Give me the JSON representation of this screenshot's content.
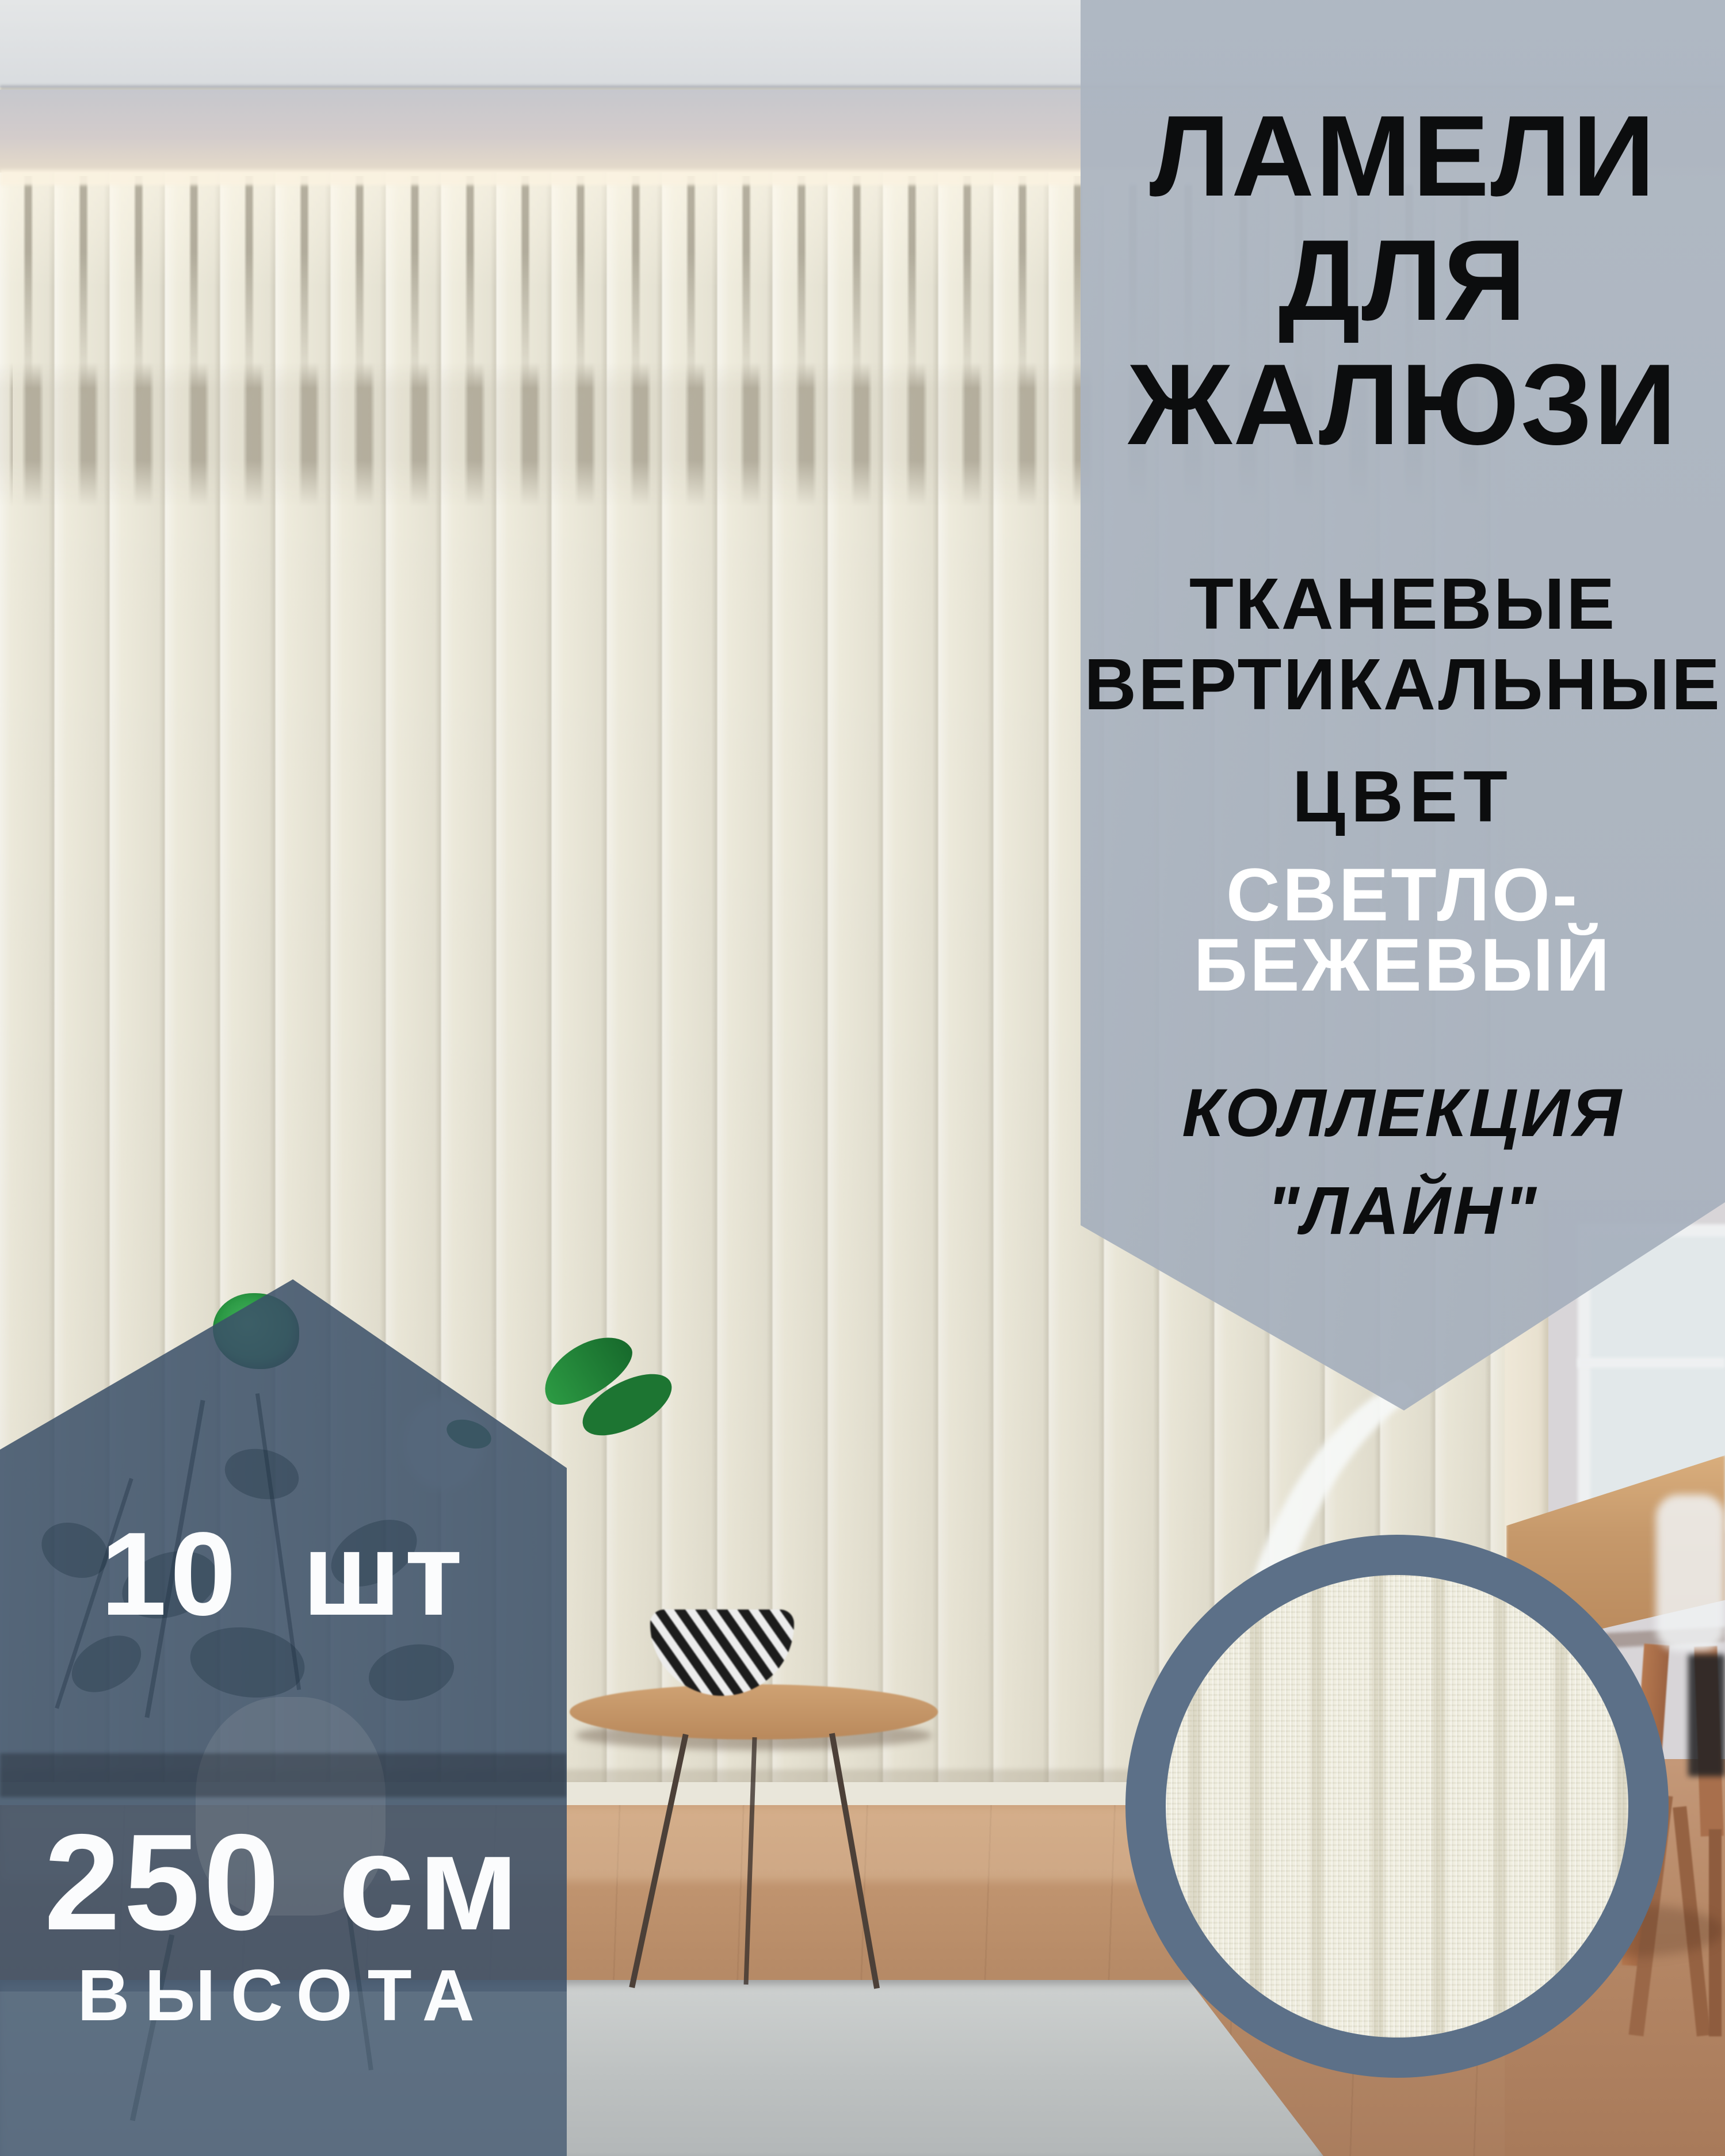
{
  "info_banner": {
    "title": [
      "ЛАМЕЛИ",
      "ДЛЯ",
      "ЖАЛЮЗИ"
    ],
    "material": [
      "ТКАНЕВЫЕ",
      "ВЕРТИКАЛЬНЫЕ"
    ],
    "color_label": "ЦВЕТ",
    "color_value": [
      "СВЕТЛО-",
      "БЕЖЕВЫЙ"
    ],
    "collection": [
      "КОЛЛЕКЦИЯ",
      "\"ЛАЙН\""
    ]
  },
  "quantity_badge": {
    "count": "10",
    "count_unit": "шт",
    "height": "250",
    "height_unit": "см",
    "height_label": "ВЫСОТА"
  },
  "colors": {
    "banner_bg": "#a9b3c0",
    "badge_bg": "#3b5069",
    "swatch_ring": "#5c7088",
    "fabric": "#f1efe1",
    "blinds": "#efecdd",
    "floor": "#b78b67",
    "title_text": "#0c0d0e",
    "light_text": "#ffffff"
  }
}
